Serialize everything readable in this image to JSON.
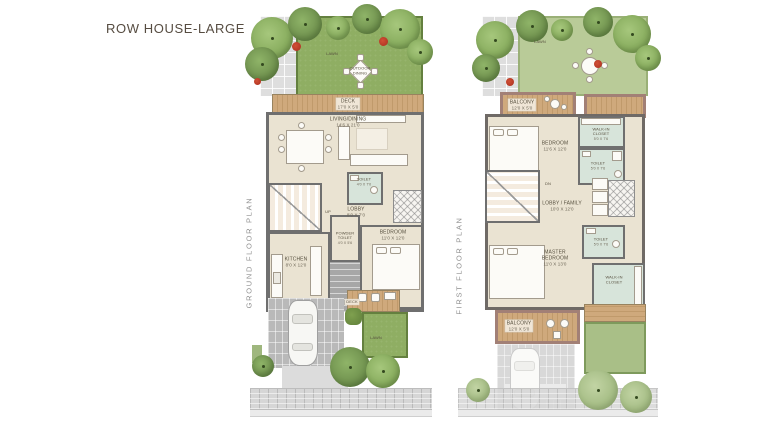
{
  "title": "ROW HOUSE-LARGE",
  "colors": {
    "lawn": "#8fae63",
    "lawn_muted": "#b9cb98",
    "deck_wood": "#c9a478",
    "wall": "#6f6f6f",
    "balcony_wall": "#a28076",
    "toilet_floor": "#d7e4da",
    "room_floor": "#eae3d2"
  },
  "plans": [
    {
      "name": "GROUND FLOOR PLAN",
      "labels": {
        "lawn_back": "LAWN",
        "outdoor_dining": "OUTDOOR\nDINING",
        "deck_name": "DECK",
        "deck_dims": "17'0 X 5'0",
        "living_name": "LIVING/DINING",
        "living_dims": "14'6 X 21'0",
        "up": "UP",
        "toilet_name": "TOILET",
        "toilet_dims": "4'0 X 7'0",
        "lobby_name": "LOBBY",
        "lobby_dims": "8'0 X 7'0",
        "powder_name": "POWDER\nTOILET",
        "powder_dims": "4'0 X 5'6",
        "kitchen_name": "KITCHEN",
        "kitchen_dims": "8'0 X 12'0",
        "bedroom_name": "BEDROOM",
        "bedroom_dims": "11'0 X 12'0",
        "deck_front": "DECK",
        "lawn_front": "LAWN"
      }
    },
    {
      "name": "FIRST FLOOR PLAN",
      "labels": {
        "lawn_top": "LAWN",
        "balcony_top_name": "BALCONY",
        "balcony_top_dims": "12'0 X 5'0",
        "bedroom_name": "BEDROOM",
        "bedroom_dims": "11'6 X 12'0",
        "closet_top_name": "WALK-IN\nCLOSET",
        "closet_top_dims": "5'0 X 7'6",
        "toilet_top_name": "TOILET",
        "toilet_top_dims": "5'0 X 7'6",
        "dn": "DN",
        "family_name": "LOBBY / FAMILY",
        "family_dims": "10'0 X 12'0",
        "master_name": "MASTER\nBEDROOM",
        "master_dims": "11'0 X 13'0",
        "toilet_bot_name": "TOILET",
        "toilet_bot_dims": "5'0 X 7'6",
        "closet_bot_name": "WALK-IN\nCLOSET",
        "balcony_bot_name": "BALCONY",
        "balcony_bot_dims": "12'0 X 5'0"
      }
    }
  ]
}
